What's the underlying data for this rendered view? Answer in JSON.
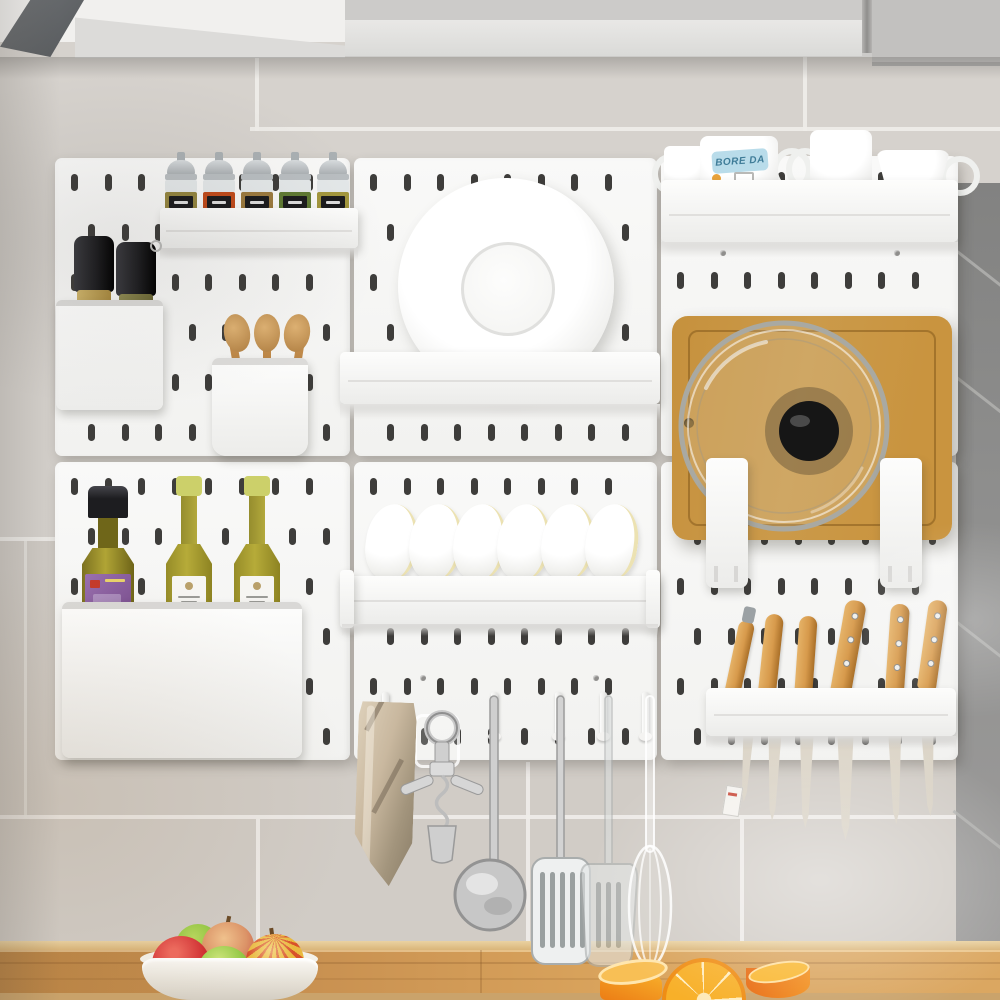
{
  "colors": {
    "wall": "#d6d2cd",
    "wall_low": "#d1ccc6",
    "grout": "#efede9",
    "dark_tile": "#8e8e8d",
    "dark_tile_grout": "#b2b1af",
    "cabinet": "#cccbc9",
    "cabinet_band": "#e9e8e6",
    "cabinet_right": "#c2c1bf",
    "cabinet_dark": "#55585b",
    "pegboard": "#f2f2f0",
    "hole": "#3e3d3b",
    "wood_back": "#ead2a2",
    "wood_main_l": "#b98344",
    "wood_main_r": "#d9a35c",
    "wood_front": "#caa36b",
    "board": "#cb9a4a",
    "handle_wood": "#d79a4c",
    "blade": "#d8d1c4",
    "bowl_edge": "#ece2b2",
    "mug_label_bg": "#b9dcea",
    "mug_label_text": "#3f7c98",
    "towel": "#c9b89f",
    "olive": "#b0a435",
    "cap_black": "#1d1d20",
    "cap_yellow": "#ccd06a",
    "label_purple": "#7b5090",
    "orange_flesh": "#f8b029",
    "orange_skin": "#ec7d15",
    "apple_red": "#d33034",
    "apple_green": "#8cc63f"
  },
  "pegboard": {
    "panel_count": 6,
    "columns": 3,
    "rows": 2
  },
  "spice_rack": {
    "jar_count": 5,
    "jar_colors": [
      "#94853f",
      "#c14a1a",
      "#9c7a3e",
      "#5f7a33",
      "#a3973d"
    ]
  },
  "grinder_bin": {
    "grinder_count": 2,
    "grinder_colors": [
      "#b89f55",
      "#7e7a42"
    ]
  },
  "utensil_cup": {
    "spoon_count": 3
  },
  "bottle_bin": {
    "bottle_count": 3
  },
  "plate_shelf": {
    "plate_count": 1
  },
  "dish_rack": {
    "bowl_count": 6
  },
  "mug_shelf": {
    "mug_count": 4,
    "mug_label": "BORE DA"
  },
  "board_rack": {
    "has_cutting_board": true,
    "has_pot_lid": true
  },
  "knife_rack": {
    "knife_count": 6
  },
  "hooks": {
    "items": [
      "towel",
      "corkscrew",
      "ladle",
      "slotted-turner",
      "spatula",
      "whisk"
    ]
  },
  "fruit_bowl": {
    "apple_count": 5
  },
  "oranges": {
    "piece_count": 3
  }
}
